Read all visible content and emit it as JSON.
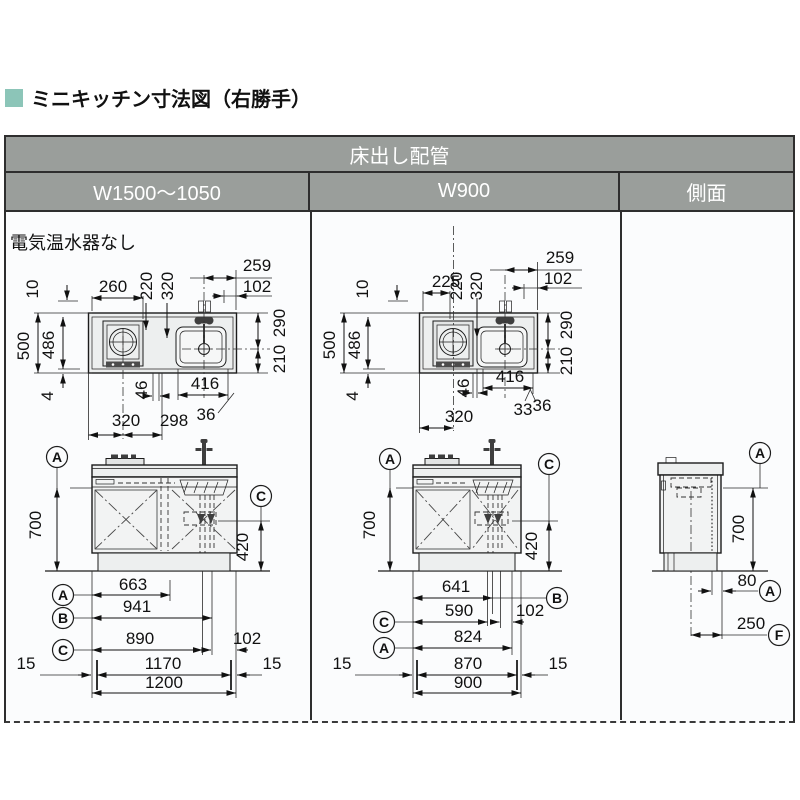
{
  "title": "ミニキッチン寸法図（右勝手）",
  "accent_color": "#8cc5b8",
  "header_color": "#9a9e9b",
  "table": {
    "header": "床出し配管",
    "columns": [
      "W1500～1050",
      "W900",
      "側面"
    ]
  },
  "w1500": {
    "note": "電気温水器なし",
    "plan": {
      "d10": "10",
      "d500": "500",
      "d486": "486",
      "d4": "4",
      "d260": "260",
      "d220": "220",
      "d320t": "320",
      "d259": "259",
      "d102": "102",
      "d290": "290",
      "d210": "210",
      "d416": "416",
      "d46": "46",
      "d36": "36",
      "d320": "320",
      "d298": "298"
    },
    "front": {
      "refA": "A",
      "refC": "C",
      "d700": "700",
      "d420": "420"
    },
    "bottom": {
      "refA": "A",
      "refB": "B",
      "refC": "C",
      "d663": "663",
      "d941": "941",
      "d890": "890",
      "d102": "102",
      "d15l": "15",
      "d1170": "1170",
      "d15r": "15",
      "d1200": "1200"
    }
  },
  "w900": {
    "plan": {
      "d10": "10",
      "d500": "500",
      "d486": "486",
      "d4": "4",
      "d225": "225",
      "d220": "220",
      "d320t": "320",
      "d259": "259",
      "d102": "102",
      "d290": "290",
      "d210": "210",
      "d416": "416",
      "d46": "46",
      "d36": "36",
      "d320": "320",
      "d33": "33"
    },
    "front": {
      "refA": "A",
      "refC": "C",
      "d700": "700",
      "d420": "420"
    },
    "bottom": {
      "refB": "B",
      "refC": "C",
      "refA": "A",
      "d641": "641",
      "d590": "590",
      "d102": "102",
      "d824": "824",
      "d15l": "15",
      "d870": "870",
      "d15r": "15",
      "d900": "900"
    }
  },
  "side": {
    "refA1": "A",
    "d700": "700",
    "d80": "80",
    "refA2": "A",
    "d250": "250",
    "refF": "F"
  }
}
